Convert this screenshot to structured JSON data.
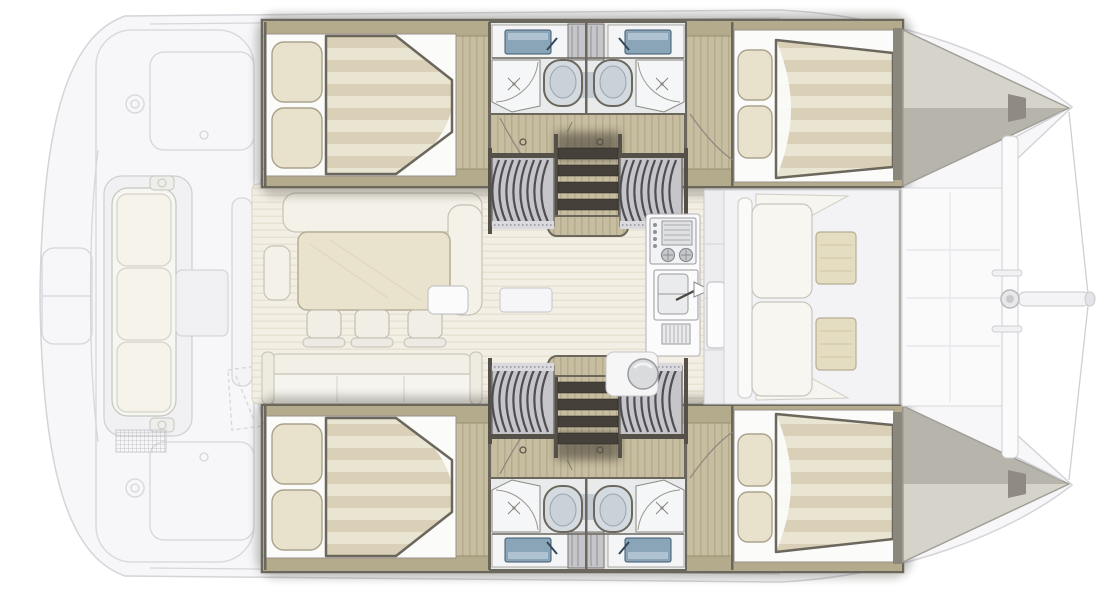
{
  "diagram": {
    "title": "Catamaran interior layout plan (top view)",
    "type": "boat-floor-plan",
    "orientation": {
      "bow": "right",
      "stern": "left",
      "upper_hull": "port",
      "lower_hull": "starboard"
    },
    "palette": {
      "deck_fill": "#f7f7f9",
      "deck_line": "#d6d6db",
      "wood": "#c7bda0",
      "wood_stripe": "#a89d7e",
      "wood_trim": "#b4aa8c",
      "wall": "#6b675d",
      "white_base": "#fbfbf9",
      "mattress_base": "#eae4d3",
      "mattress_stripe": "#d7cdb4",
      "pillow": "#e8e1cc",
      "bathroom_panel": "#f4f5f6",
      "sink_blue": "#8aa4b8",
      "toilet": "#c9d2d9",
      "rib_cover": "#c6c6ca",
      "rib_line": "#4e4e54",
      "step_tread": "#45413a",
      "saloon_floor": "#f3efe5",
      "saloon_stripe": "#e3ddca",
      "settee": "#f4f1e9",
      "sofa": "#f6f4ee",
      "stool": "#f1eee6",
      "table_wood": "#e9e2cd",
      "cockpit_table": "#e5ddc1",
      "galley_white": "#fbfbfc",
      "steel": "#c6c9cb",
      "bow_deck_light": "#d6d3cb",
      "bow_deck_dark": "#b7b4ac",
      "rig": "#cfcfd4"
    },
    "features": {
      "double_berths": 4,
      "bathrooms": 4,
      "toilets": 4,
      "showers": 4,
      "hull_sinks": 4,
      "companionways": 2,
      "saloon_stools": 3,
      "labels": [
        "aft-double-berth-port",
        "forward-double-berth-port",
        "aft-double-berth-starboard",
        "forward-double-berth-starboard",
        "bathroom-shower-toilet-sink-port",
        "bathroom-shower-toilet-sink-starboard",
        "companionway-steps-port",
        "companionway-steps-starboard",
        "saloon-dinette-table",
        "saloon-l-settee",
        "saloon-stools",
        "saloon-aft-sofa",
        "galley-stove",
        "galley-sink",
        "galley-dish-rack",
        "aft-cockpit-bench",
        "aft-cockpit-table",
        "transom-vent",
        "forward-cockpit-seats",
        "forward-cockpit-tables",
        "forward-crossbeam",
        "bowsprit",
        "forestay-bridle",
        "bow-deck"
      ]
    }
  }
}
